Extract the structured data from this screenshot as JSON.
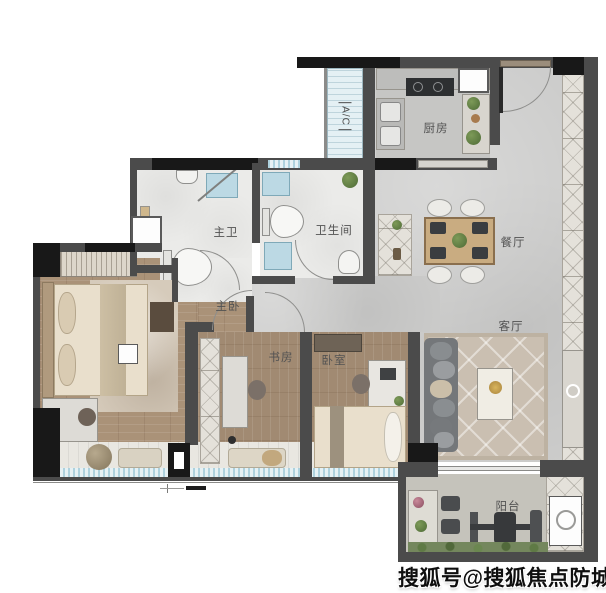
{
  "labels": {
    "kitchen": "厨房",
    "ac": "A/C",
    "bathroom": "卫生间",
    "master_bath": "主卫",
    "dining": "餐厅",
    "master_bedroom": "主卧",
    "living": "客厅",
    "study": "书房",
    "bedroom": "卧室",
    "balcony": "阳台"
  },
  "watermark": "搜狐号@搜狐焦点防城港站",
  "colors": {
    "wall": "#4b4b4b",
    "column": "#181818",
    "concrete_floor": "#cccccb",
    "wood_floor": "#aa9278",
    "marble_floor": "#ebebe9",
    "window_glass": "#aed2de",
    "rug": "#cabfb1",
    "greenery": "#5f7a45"
  }
}
